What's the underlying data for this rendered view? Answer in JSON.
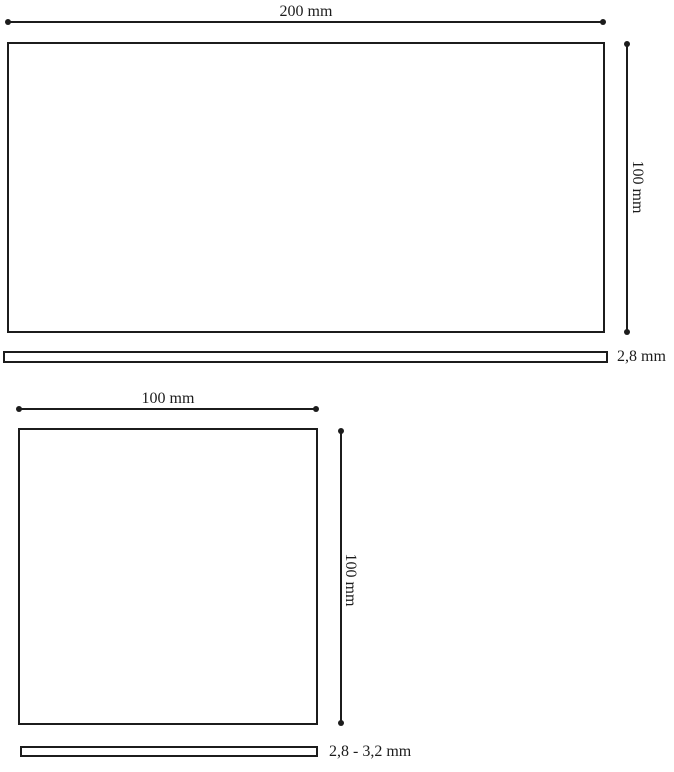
{
  "page": {
    "background_color": "#ffffff",
    "line_color": "#1c1c1c"
  },
  "large_tile": {
    "name": "large tile technical drawing",
    "width_label": "200 mm",
    "height_label": "100 mm",
    "thickness_label": "2,8 mm"
  },
  "small_tile": {
    "name": "small tile technical drawing",
    "width_label": "100 mm",
    "height_label": "100 mm",
    "thickness_label": "2,8 - 3,2 mm"
  }
}
